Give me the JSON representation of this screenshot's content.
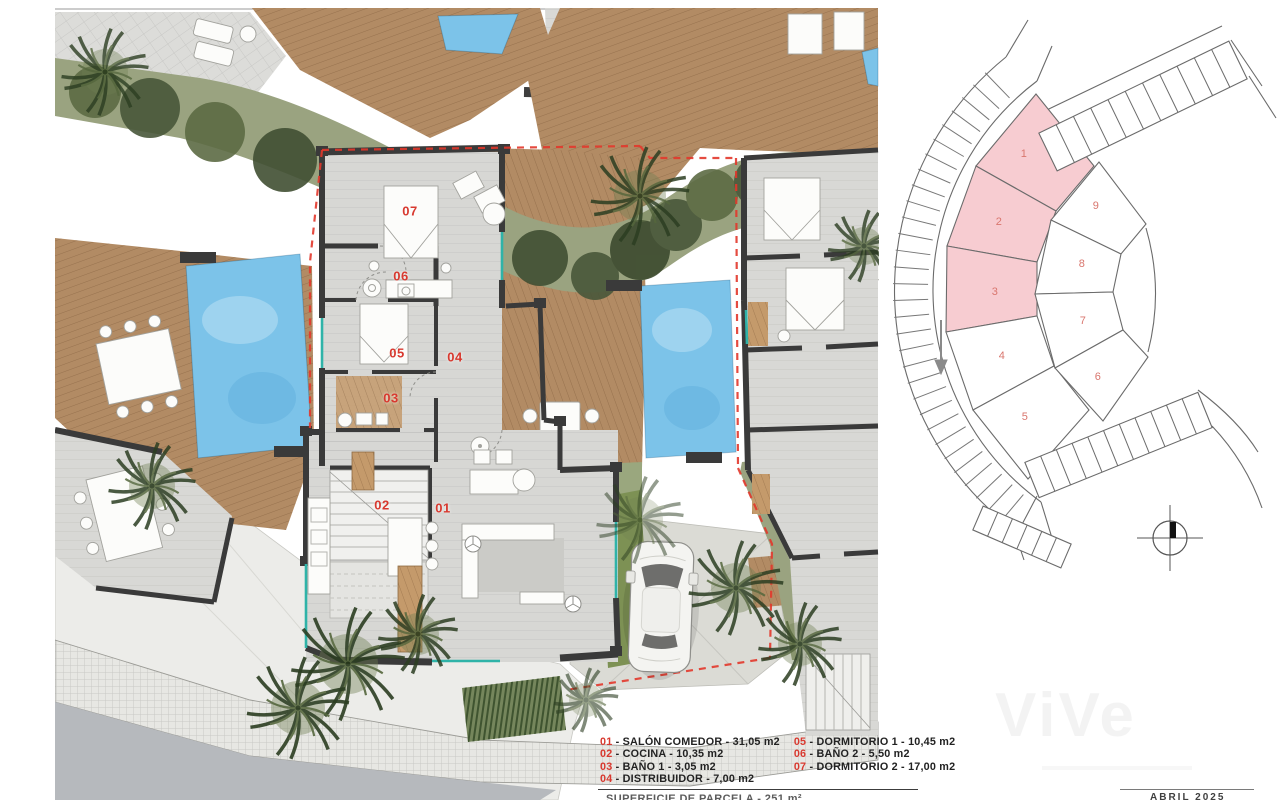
{
  "floor_plan": {
    "room_labels": [
      "01",
      "02",
      "03",
      "04",
      "05",
      "06",
      "07"
    ]
  },
  "site_plan": {
    "plot_numbers": [
      "1",
      "2",
      "3",
      "4",
      "5",
      "6",
      "7",
      "8",
      "9"
    ],
    "highlighted_plots": [
      "1",
      "2",
      "3"
    ]
  },
  "legend": {
    "separator": " - ",
    "items": [
      {
        "num": "01",
        "name": "SALÓN COMEDOR",
        "area": "31,05 m2"
      },
      {
        "num": "02",
        "name": "COCINA",
        "area": "10,35 m2"
      },
      {
        "num": "03",
        "name": "BAÑO 1",
        "area": "3,05 m2"
      },
      {
        "num": "04",
        "name": "DISTRIBUIDOR",
        "area": "7,00 m2"
      },
      {
        "num": "05",
        "name": "DORMITORIO 1",
        "area": "10,45 m2"
      },
      {
        "num": "06",
        "name": "BAÑO 2",
        "area": "5,50 m2"
      },
      {
        "num": "07",
        "name": "DORMITORIO 2",
        "area": "17,00 m2"
      }
    ]
  },
  "footer": {
    "parcel_label": "SUPERFICIE DE PARCELA - 251 m²",
    "date": "ABRIL 2025"
  },
  "watermark": {
    "text": "ViVe"
  },
  "colors": {
    "plot_highlight": "#f7ccd1",
    "plot_number": "#d9766e",
    "room_label": "#d8392f",
    "legend_number": "#d8392f",
    "pool": "#7cc3e9",
    "deck": "#b28b64",
    "vegetation": "#9aa380",
    "wall": "#3a3a3a",
    "boundary": "#e2372b",
    "accent_teal": "#2fb3a8"
  }
}
